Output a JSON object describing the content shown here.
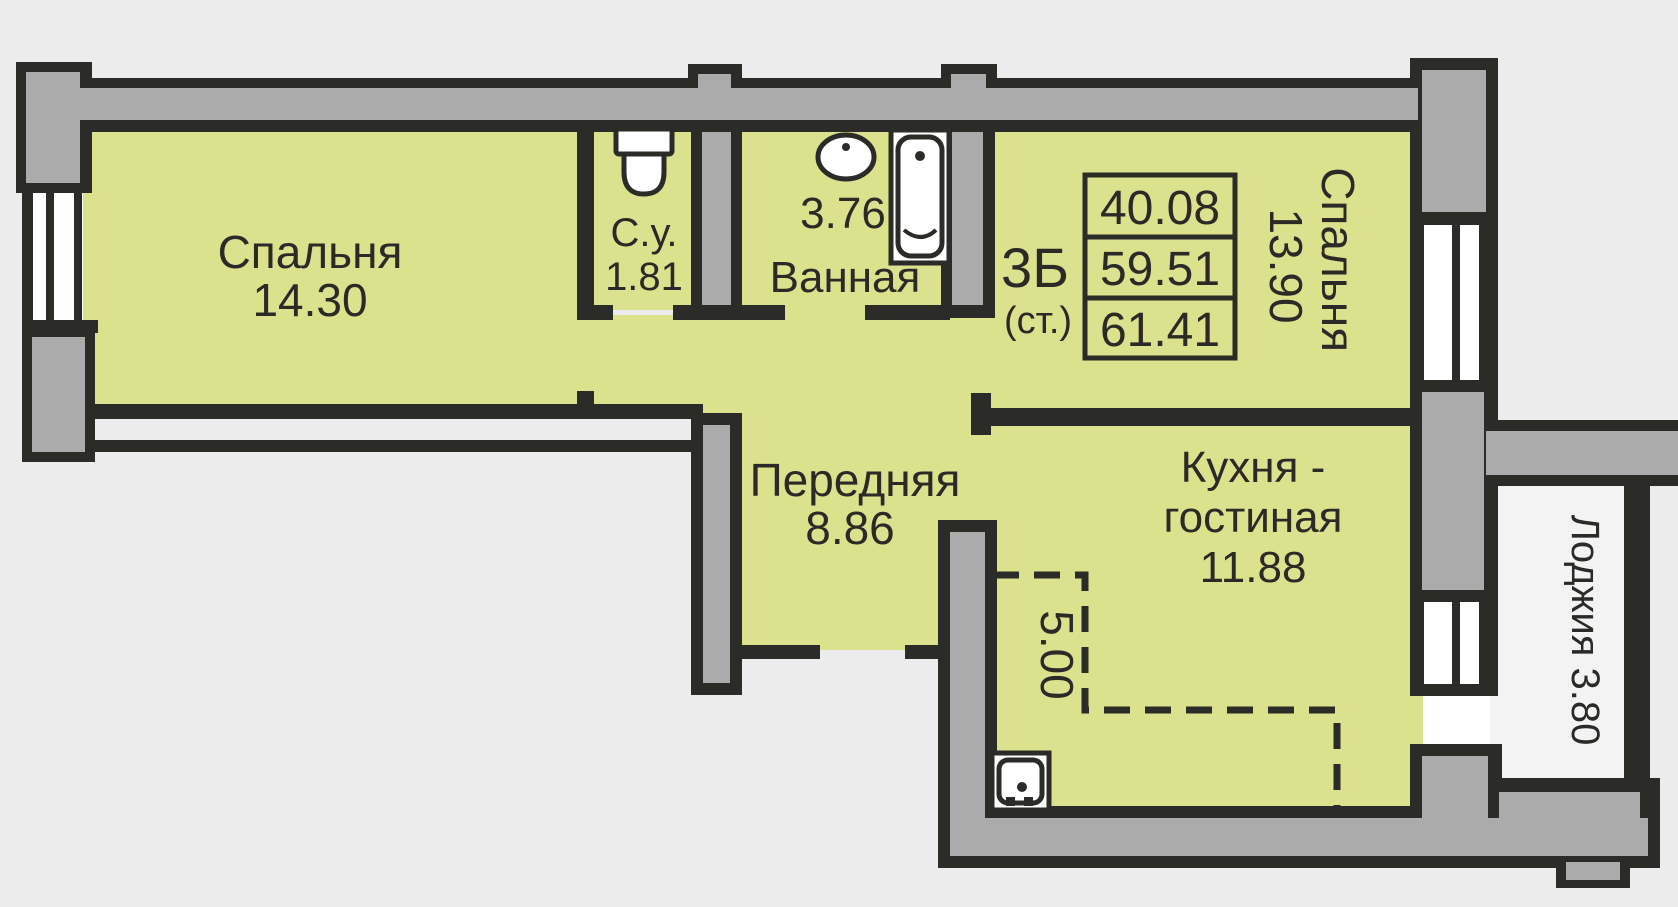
{
  "colors": {
    "background": "#ececec",
    "room": "#dce18d",
    "wall": "#ababab",
    "outline": "#2b2b28",
    "white": "#ffffff",
    "loggia": "#f3f3f3",
    "text": "#2b2a26"
  },
  "rooms": [
    {
      "name": "Спальня",
      "area": "14.30"
    },
    {
      "name": "С.у.",
      "area": "1.81"
    },
    {
      "name": "Ванная",
      "area": "3.76"
    },
    {
      "name": "Спальня",
      "area": "13.90"
    },
    {
      "name": "Передняя",
      "area": "8.86"
    },
    {
      "name_line1": "Кухня -",
      "name_line2": "гостиная",
      "area": "11.88"
    },
    {
      "label": "Лоджия 3.80"
    }
  ],
  "stamp": {
    "type": "3Б",
    "note": "(ст.)",
    "values": [
      "40.08",
      "59.51",
      "61.41"
    ]
  },
  "annotations": {
    "kitchen_niche": "5.00"
  }
}
